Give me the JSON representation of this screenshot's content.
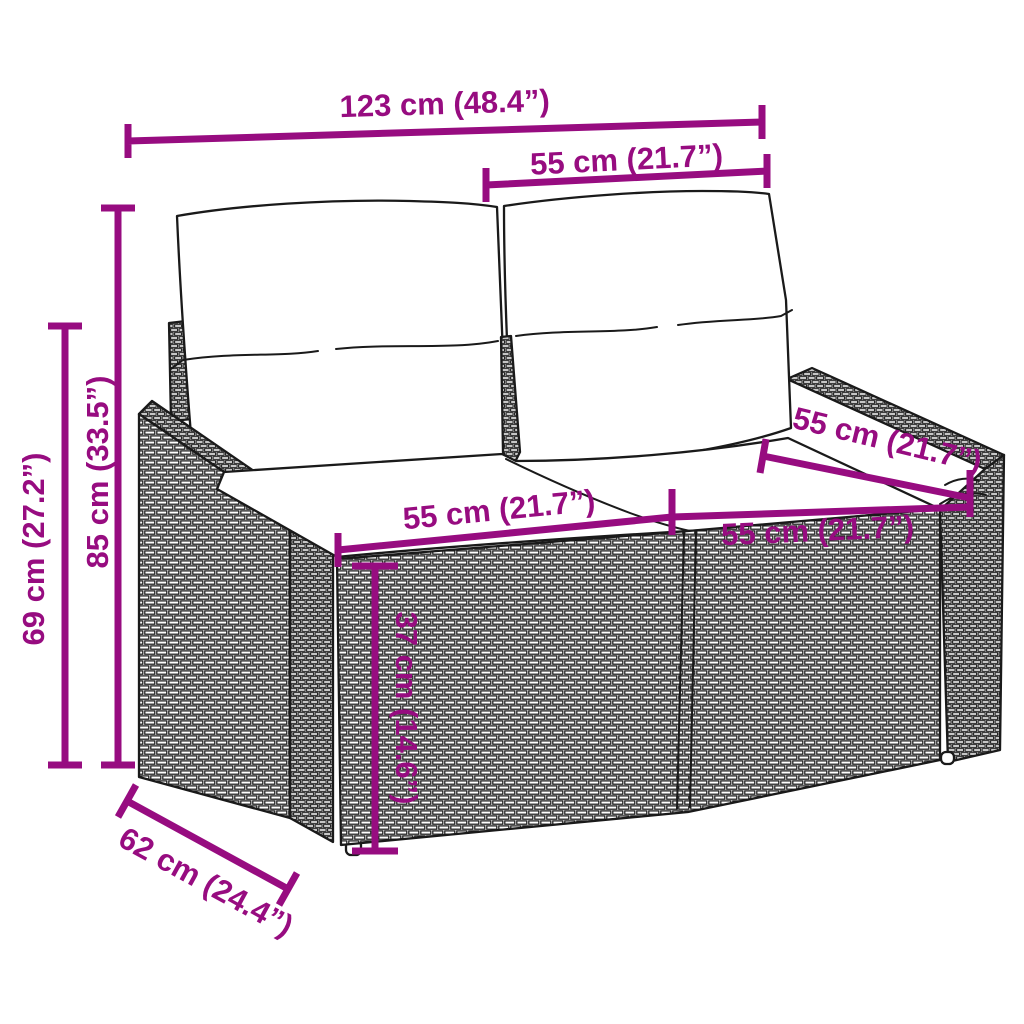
{
  "figure": {
    "type": "product dimension diagram",
    "subject": "two-seater poly rattan garden sofa with back and seat cushions",
    "colors": {
      "dimension_annotation": "#970C80",
      "artwork_outline": "#1A1A1A",
      "background": "#FFFFFF"
    },
    "dimensions": {
      "overall_width": "123 cm (48.4”)",
      "backrest_section_width": "55 cm (21.7”)",
      "total_height": "85 cm (33.5”)",
      "armrest_height": "69 cm (27.2”)",
      "left_seat_width": "55 cm (21.7”)",
      "right_seat_width": "55 cm (21.7”)",
      "seat_depth": "55 cm (21.7”)",
      "seat_height": "37 cm (14.6”)",
      "overall_depth": "62 cm (24.4”)"
    }
  }
}
